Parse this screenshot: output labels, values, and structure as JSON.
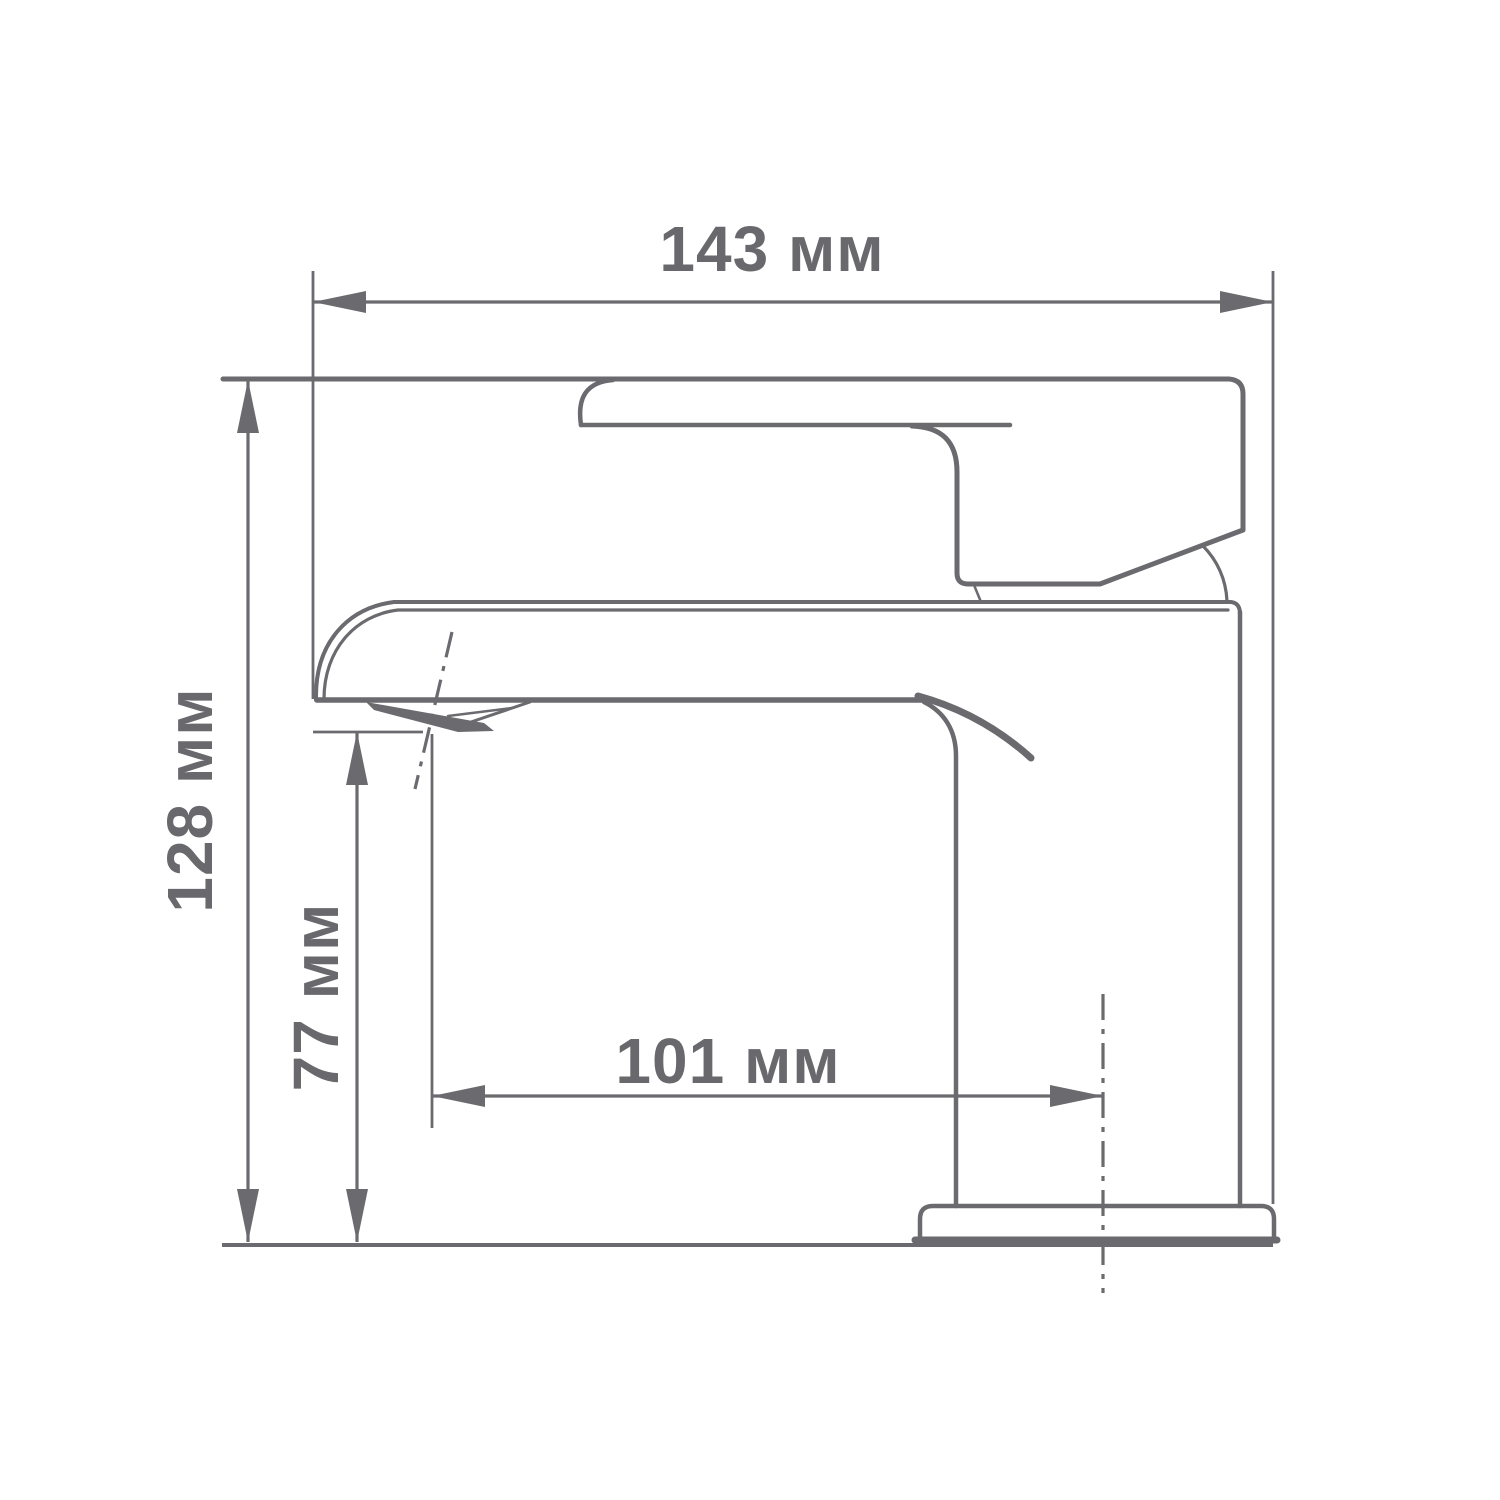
{
  "drawing": {
    "type": "technical-dimension-drawing",
    "subject": "single-lever-basin-faucet-side-view",
    "unit": "мм",
    "dimensions": {
      "overall_width": {
        "value": 143,
        "label": "143 мм",
        "orientation": "horizontal",
        "position": "top"
      },
      "overall_height": {
        "value": 128,
        "label": "128 мм",
        "orientation": "vertical",
        "position": "left"
      },
      "spout_height": {
        "value": 77,
        "label": "77 мм",
        "orientation": "vertical",
        "position": "inner-left"
      },
      "spout_reach": {
        "value": 101,
        "label": "101 мм",
        "orientation": "horizontal",
        "position": "middle"
      }
    },
    "colors": {
      "line": "#6a6a6f",
      "text": "#68686d",
      "background": "#ffffff"
    }
  }
}
